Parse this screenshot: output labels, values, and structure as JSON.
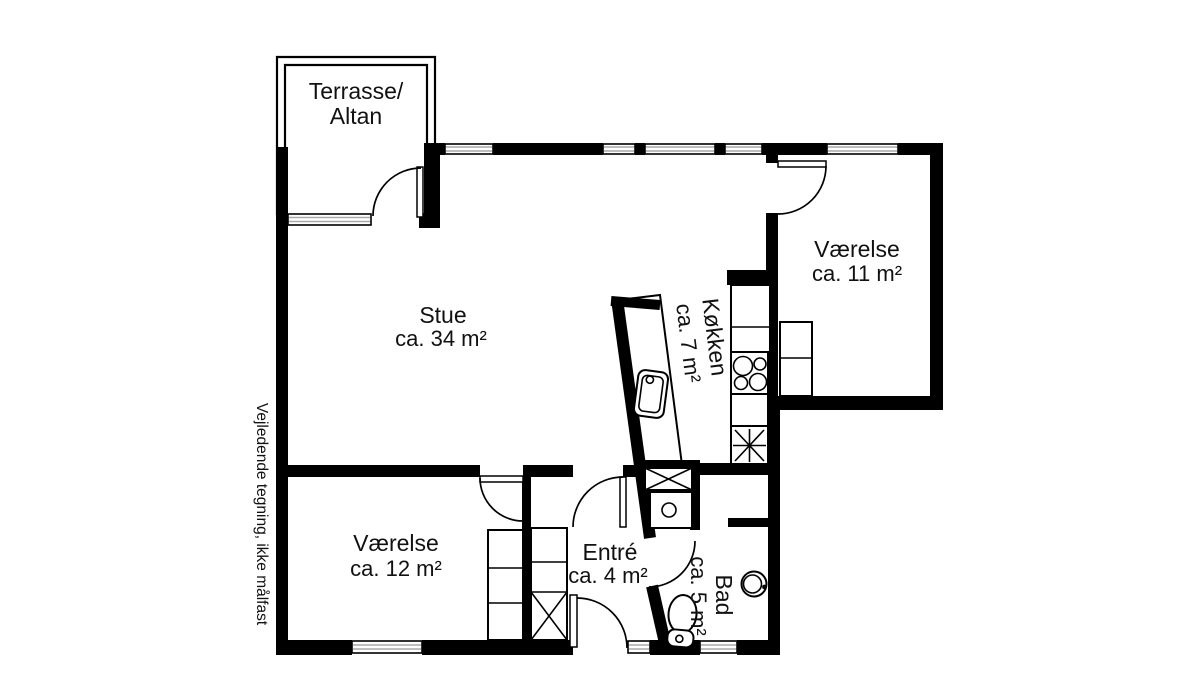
{
  "disclaimer": "Vejledende tegning, ikke målfast",
  "rooms": {
    "terrace": {
      "line1": "Terrasse/",
      "line2": "Altan"
    },
    "living_room": {
      "name": "Stue",
      "area": "ca. 34 m²"
    },
    "bedroom_right": {
      "name": "Værelse",
      "area": "ca. 11 m²"
    },
    "kitchen": {
      "name": "Køkken",
      "area": "ca. 7 m²"
    },
    "bedroom_left": {
      "name": "Værelse",
      "area": "ca. 12 m²"
    },
    "entry": {
      "name": "Entré",
      "area": "ca. 4 m²"
    },
    "bathroom": {
      "name": "Bad",
      "area": "ca. 5 m²"
    }
  },
  "colors": {
    "wall": "#000000",
    "background": "#ffffff",
    "window_line": "#a9a9a9",
    "text": "#111111"
  }
}
